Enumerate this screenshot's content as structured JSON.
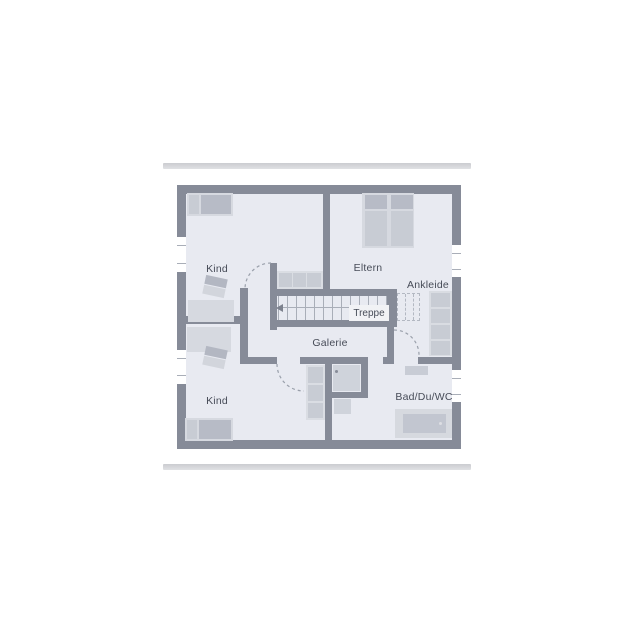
{
  "floorplan": {
    "rooms": [
      {
        "id": "kind-top",
        "label": "Kind"
      },
      {
        "id": "eltern",
        "label": "Eltern"
      },
      {
        "id": "ankleide",
        "label": "Ankleide"
      },
      {
        "id": "treppe",
        "label": "Treppe"
      },
      {
        "id": "galerie",
        "label": "Galerie"
      },
      {
        "id": "kind-bottom",
        "label": "Kind"
      },
      {
        "id": "bad",
        "label": "Bad/Du/WC"
      }
    ],
    "colors": {
      "wall": "#868b98",
      "floor": "#e8eaf1",
      "furniture_light": "#d6d9e0",
      "furniture_dark": "#b7bbc6",
      "furniture_mid": "#c8ccd4",
      "window": "#ffffff",
      "divider_bar": "#d2d3d6",
      "label_text": "#474c58",
      "door_arc": "#9aa0ab"
    }
  }
}
